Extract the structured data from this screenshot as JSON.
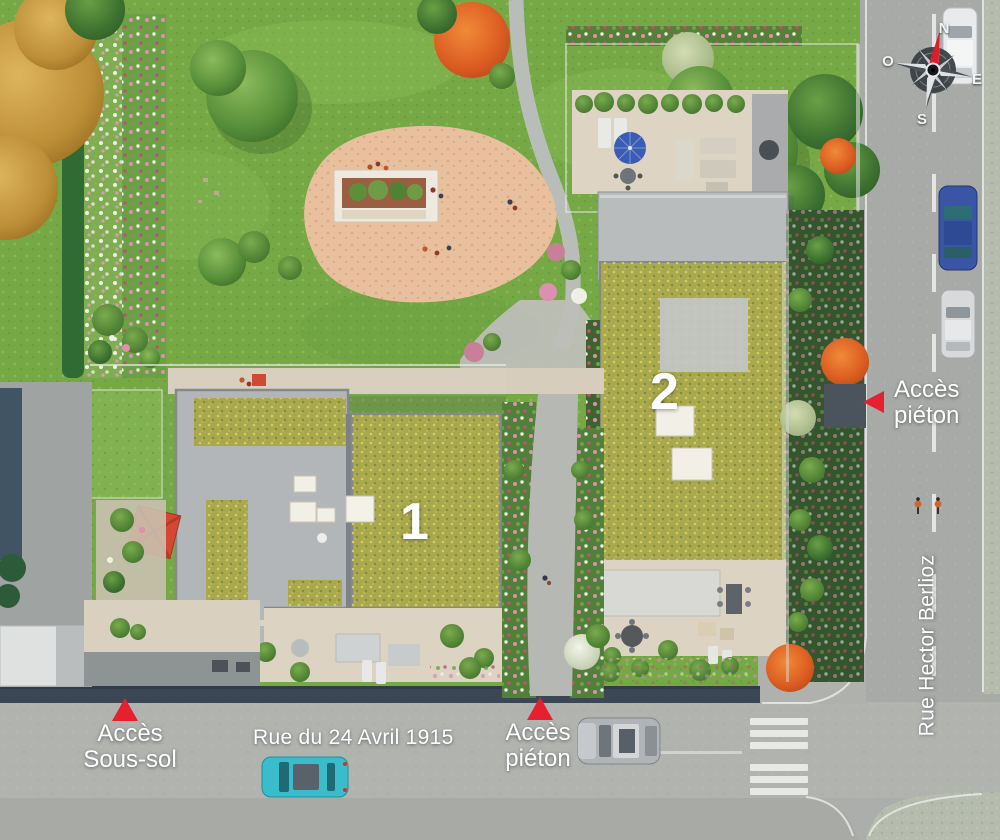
{
  "plan_labels": {
    "building_1": "1",
    "building_2": "2",
    "street_bottom": "Rue du 24 Avril 1915",
    "street_right": "Rue Hector Berlioz",
    "access_pedestrian_right": "Accès\npiéton",
    "access_pedestrian_bottom": "Accès\npiéton",
    "access_basement": "Accès\nSous-sol"
  },
  "compass": {
    "north": "N",
    "south": "S",
    "east": "E",
    "west": "O"
  },
  "colors": {
    "accent_red": "#e6202e",
    "label_text": "#ffffff",
    "lawn_green": "#76a845",
    "moss_roof": "#a8a84e",
    "road_gray": "#aaada8",
    "plaza_sand": "#e8c09e"
  }
}
